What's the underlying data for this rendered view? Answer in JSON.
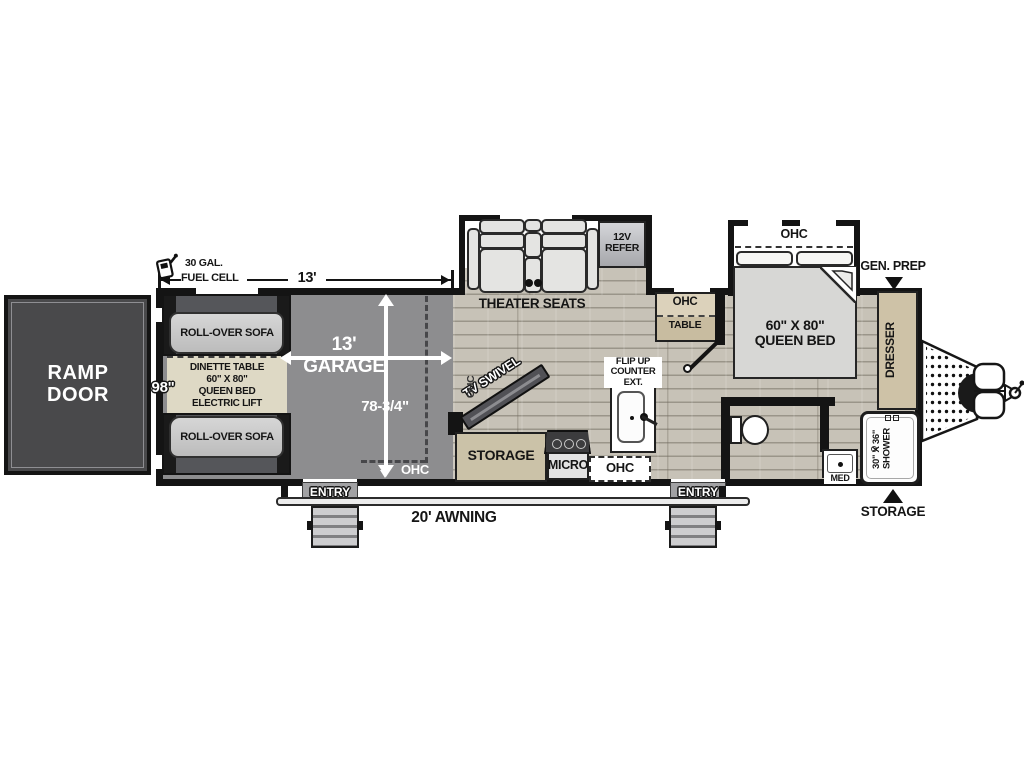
{
  "plan": {
    "ramp_door": "RAMP\nDOOR",
    "fuel_amount": "30 GAL.",
    "fuel_label": "FUEL CELL",
    "dim_garage_length": "13'",
    "dim_body_width": "98\"",
    "dim_garage_interior": "78-3/4\"",
    "garage_title": "13'\nGARAGE",
    "sofa_top": "ROLL-OVER SOFA",
    "sofa_bottom": "ROLL-OVER SOFA",
    "dinette": "DINETTE TABLE\n60\" X 80\"\nQUEEN BED\nELECTRIC LIFT",
    "ohc_garage_rear": "OHC",
    "ohc_living_side": "OHC",
    "theater": "THEATER SEATS",
    "refer": "12V\nREFER",
    "tv": "TV SWIVEL",
    "storage_kitchen": "STORAGE",
    "micro": "MICRO",
    "ohc_kitchen": "OHC",
    "flip_up": "FLIP UP\nCOUNTER\nEXT.",
    "ohc_table_top": "OHC",
    "ohc_table_bottom": "TABLE",
    "bed_ohc": "OHC",
    "bed": "60\" X 80\"\nQUEEN BED",
    "gen_prep": "GEN. PREP",
    "dresser": "DRESSER",
    "shower": "30\" X 36\"\nSHOWER",
    "med": "MED",
    "storage_rear": "STORAGE",
    "entry_left": "ENTRY",
    "entry_right": "ENTRY",
    "awning": "20' AWNING"
  },
  "colors": {
    "wall": "#141414",
    "garage_floor": "#8d8d8f",
    "wood_floor": "#c7c2b7",
    "ramp_door": "#49494b",
    "cabinet_tan": "#cbc2a8",
    "dinette_tan": "#ded9c5"
  }
}
